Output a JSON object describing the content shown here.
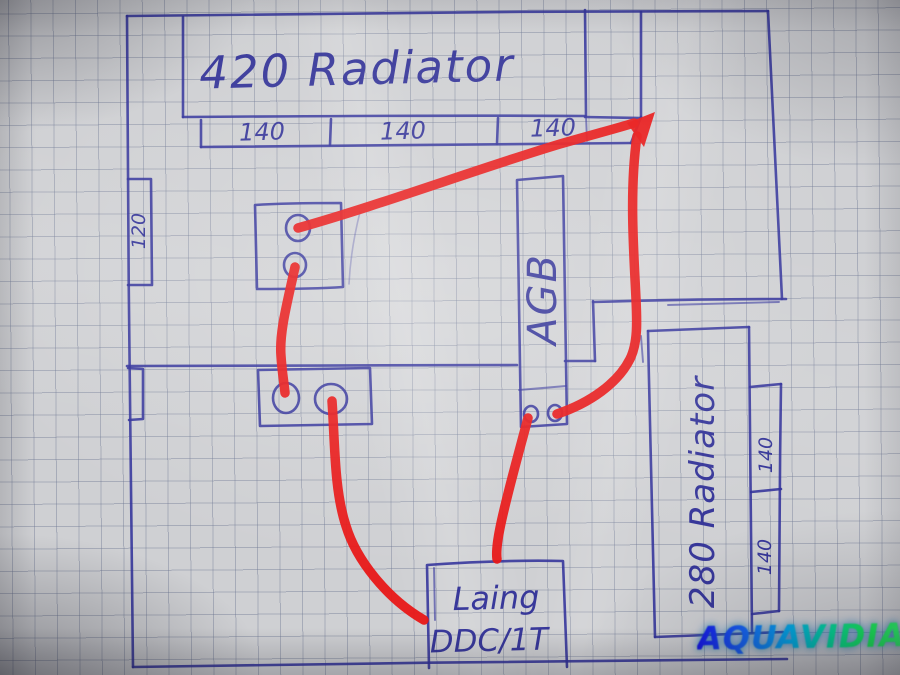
{
  "scene": {
    "description": "Photographed hand-drawn PC watercooling loop floor-plan sketch on squared graph paper",
    "ink_color": "#32329b",
    "tube_color": "#e81717",
    "paper_color": "#cfd0d3",
    "grid_color": "#6a7490",
    "watermark_gradient": [
      "#1515e8",
      "#00a8e8",
      "#17e857"
    ]
  },
  "labels": {
    "top_radiator": "420 Radiator",
    "top_radiator_segments": [
      "140",
      "140",
      "140"
    ],
    "left_dimension": "120",
    "reservoir": "AGB",
    "right_radiator": "280 Radiator",
    "right_radiator_segments": [
      "140",
      "140"
    ],
    "pump_line1": "Laing",
    "pump_line2": "DDC/1T",
    "watermark": "AQUAVIDIA"
  },
  "tubing_connections": [
    {
      "from": "upper block port",
      "to": "420 radiator strip right end (arrowhead)"
    },
    {
      "from": "upper block port",
      "to": "lower block port"
    },
    {
      "from": "lower block port",
      "to": "Laing DDC/1T pump left side"
    },
    {
      "from": "AGB reservoir port",
      "to": "Laing DDC/1T pump top"
    },
    {
      "from": "AGB reservoir port",
      "to": "420 radiator strip right end (arrowhead)"
    }
  ]
}
